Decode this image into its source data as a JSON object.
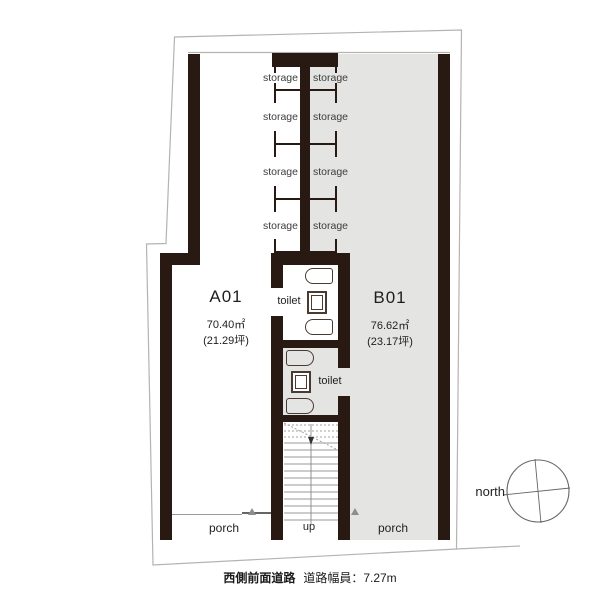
{
  "plan": {
    "units": [
      {
        "id": "A01",
        "area_m2": "70.40㎡",
        "area_tsubo": "(21.29坪)"
      },
      {
        "id": "B01",
        "area_m2": "76.62㎡",
        "area_tsubo": "(23.17坪)"
      }
    ],
    "storage_labels": [
      "storage",
      "storage",
      "storage",
      "storage",
      "storage",
      "storage",
      "storage",
      "storage"
    ],
    "toilet_labels": [
      "toilet",
      "toilet"
    ],
    "porch_labels": [
      "porch",
      "porch"
    ],
    "stair_label": "up",
    "north_label": "north"
  },
  "caption": {
    "road_name": "西側前面道路",
    "road_width": "道路幅員：7.27m"
  },
  "colors": {
    "wall": "#281a12",
    "unit_b_fill": "#e4e4e3",
    "boundary": "#b5b3b0",
    "fixture": "#4a3a30"
  }
}
